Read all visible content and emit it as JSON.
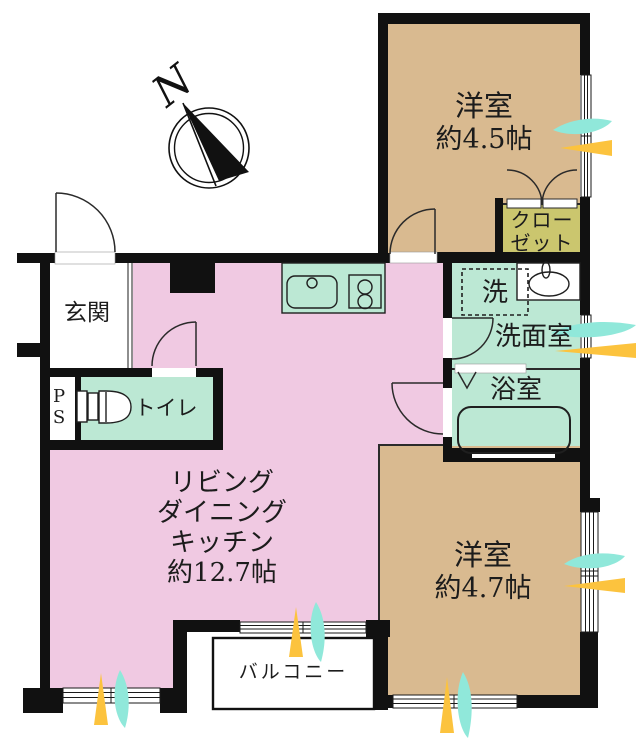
{
  "floorplan": {
    "compass_label": "N",
    "labels": {
      "bedroom45_name": "洋室",
      "bedroom45_size": "約4.5帖",
      "closet_line1": "クロー",
      "closet_line2": "ゼット",
      "washer": "洗",
      "washroom": "洗面室",
      "bathroom": "浴室",
      "bedroom47_name": "洋室",
      "bedroom47_size": "約4.7帖",
      "ldk_line1": "リビング",
      "ldk_line2": "ダイニング",
      "ldk_line3": "キッチン",
      "ldk_line4": "約12.7帖",
      "entrance": "玄関",
      "ps_line1": "P",
      "ps_line2": "S",
      "toilet": "トイレ",
      "balcony": "バルコニー"
    },
    "colors": {
      "room_pink": "#f0c9e2",
      "room_tan": "#d9ba90",
      "room_green": "#bce8d4",
      "closet_olive": "#cbc66e",
      "arrow_yellow": "#fcc33e",
      "arrow_cyan": "#90e8da",
      "wall_black": "#111111"
    }
  }
}
